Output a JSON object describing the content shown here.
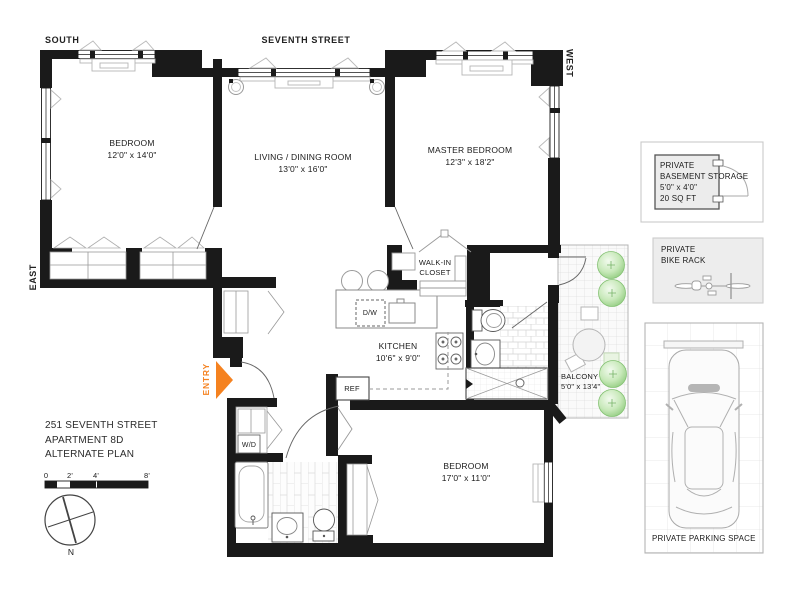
{
  "plan": {
    "street_label": "SEVENTH STREET",
    "compass": {
      "south": "SOUTH",
      "west": "WEST",
      "east": "EAST",
      "north": "N"
    },
    "entry": {
      "label": "ENTRY"
    },
    "rooms": {
      "bedroom1": {
        "name": "BEDROOM",
        "dims": "12'0\" x 14'0\""
      },
      "living": {
        "name": "LIVING / DINING ROOM",
        "dims": "13'0\" x 16'0\""
      },
      "master": {
        "name": "MASTER BEDROOM",
        "dims": "12'3\" x 18'2\""
      },
      "walk_in_closet": {
        "line1": "WALK-IN",
        "line2": "CLOSET"
      },
      "kitchen": {
        "name": "KITCHEN",
        "dims": "10'6\" x 9'0\""
      },
      "balcony": {
        "name": "BALCONY",
        "dims": "5'0\" x 13'4\""
      },
      "bedroom2": {
        "name": "BEDROOM",
        "dims": "17'0\" x 11'0\""
      }
    },
    "appliances": {
      "dishwasher": "D/W",
      "refrigerator": "REF",
      "washer_dryer": "W/D"
    },
    "title_block": {
      "line1": "251 SEVENTH STREET",
      "line2": "APARTMENT 8D",
      "line3": "ALTERNATE PLAN"
    },
    "scale_bar": {
      "tick0": "0",
      "tick2": "2'",
      "tick4": "4'",
      "tick8": "8'"
    }
  },
  "amenities": {
    "basement_storage": {
      "line1": "PRIVATE",
      "line2": "BASEMENT STORAGE",
      "line3": "5'0\" x 4'0\"",
      "line4": "20 SQ FT"
    },
    "bike_rack": {
      "line1": "PRIVATE",
      "line2": "BIKE RACK"
    },
    "parking": {
      "label": "PRIVATE PARKING SPACE"
    }
  },
  "colors": {
    "wall": "#1a1a1a",
    "accent_orange": "#F58220",
    "tree_green": "#8CC97A",
    "panel_gray": "#ededed"
  }
}
